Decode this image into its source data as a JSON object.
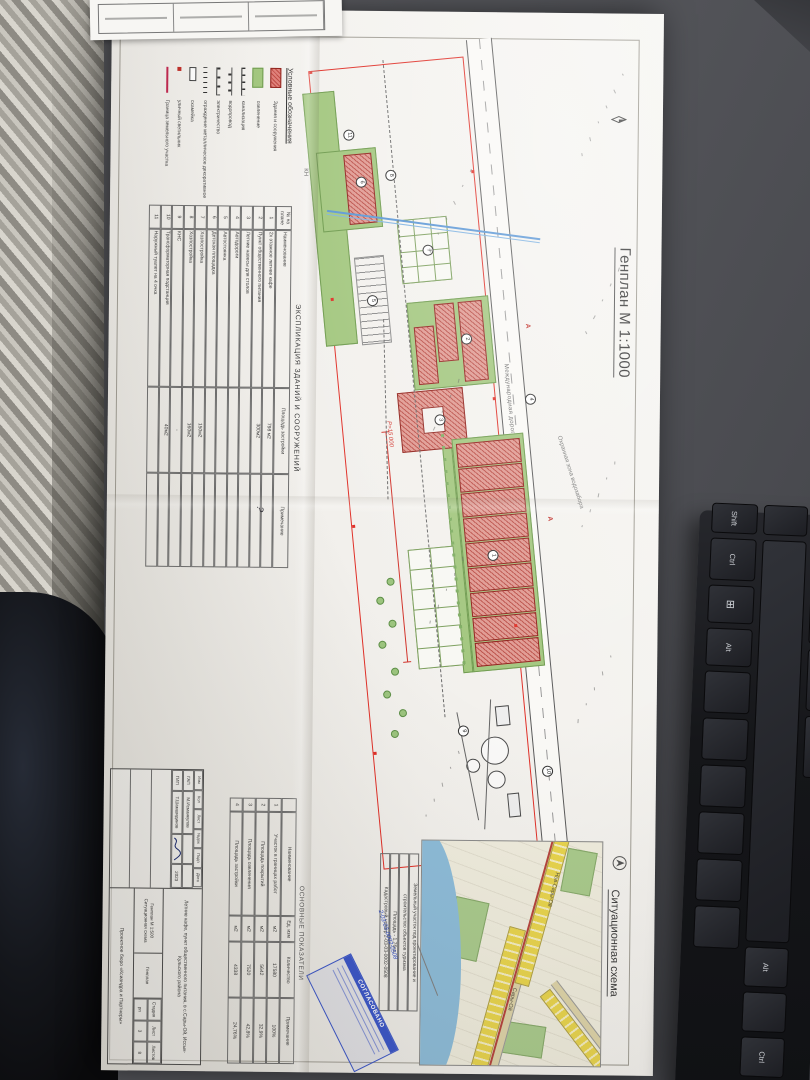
{
  "document": {
    "title": "Генплан М 1:1000",
    "situational_title": "Ситуационная схема",
    "kn_label": "КН"
  },
  "plan": {
    "road_label": "Международная дорога",
    "zone_label": "Охранная зона водозабора",
    "radius_label": "Р=15 000",
    "section_mark": "А",
    "badges": [
      "1",
      "2",
      "3",
      "4",
      "5",
      "6",
      "7",
      "8",
      "9",
      "10",
      "11"
    ]
  },
  "legend": {
    "title": "Условные обозначения",
    "items": [
      {
        "symbol": "building",
        "label": "Здания и сооружения"
      },
      {
        "symbol": "greenery",
        "label": "озеленение"
      },
      {
        "symbol": "sewer",
        "label": "канализация"
      },
      {
        "symbol": "water",
        "label": "водопровод"
      },
      {
        "symbol": "electric",
        "label": "электричество"
      },
      {
        "symbol": "fence",
        "label": "ограждение металлическое декоративное"
      },
      {
        "symbol": "bench",
        "label": "скамейка"
      },
      {
        "symbol": "lamp",
        "label": "уличный светильник"
      },
      {
        "symbol": "boundary",
        "label": "Граница земельного участка"
      }
    ]
  },
  "explication": {
    "title": "ЭКСПЛИКАЦИЯ ЗДАНИЙ И СООРУЖЕНИЙ",
    "columns": [
      "№ на плане",
      "Наименование",
      "Площадь застройки",
      "Примечание"
    ],
    "rows": [
      [
        "1",
        "2х этажное летнее кафе",
        "798 м2",
        ""
      ],
      [
        "2",
        "Пункт общественного питания",
        "300м2",
        ""
      ],
      [
        "3",
        "Летние навесы для столов",
        "",
        ""
      ],
      [
        "4",
        "Автодороги",
        "",
        ""
      ],
      [
        "5",
        "Автостоянка",
        "",
        ""
      ],
      [
        "6",
        "Детская площадка",
        "",
        ""
      ],
      [
        "7",
        "Хозпостройка",
        "150м2",
        ""
      ],
      [
        "8",
        "Хозпостройка",
        "160м2",
        ""
      ],
      [
        "9",
        "КНС",
        "-",
        ""
      ],
      [
        "10",
        "Трансформаторная подстанция",
        "40м2",
        ""
      ],
      [
        "11",
        "Наружный туалет на 4 очка",
        "",
        ""
      ]
    ],
    "handwritten_mark": "?"
  },
  "indicators": {
    "title": "ОСНОВНЫЕ ПОКАЗАТЕЛИ",
    "columns": [
      "",
      "Наименование",
      "Ед. изм",
      "Количество",
      "Примечание"
    ],
    "rows": [
      [
        "1",
        "Участок в границах работ",
        "м2",
        "17580",
        "100%"
      ],
      [
        "2",
        "Площадь покрытий",
        "м2",
        "5642",
        "32,9%"
      ],
      [
        "3",
        "Площадь озеленения",
        "м2",
        "7520",
        "42,8%"
      ],
      [
        "4",
        "Площадь застройки",
        "м2",
        "4338",
        "24,76%"
      ]
    ]
  },
  "situational_map": {
    "settlements": [
      "Нов-Сары-Ой",
      "Сары-Ой"
    ],
    "annotation_lines": [
      "Земельный участок под проектирование и",
      "строительство объектов туризма",
      "Площадь - 1,76га.",
      "Кадастровый номер 2-03-03-0002-0508"
    ],
    "stamp_text": "СОГЛАСОВАНО",
    "pen_note": "2-03-03-0002-0508"
  },
  "titleblock": {
    "header_cells": [
      "Изм",
      "Кол",
      "Лист",
      "№док",
      "Подп",
      "Дата"
    ],
    "signers": [
      {
        "role": "ГАП",
        "name": "М.Исманкулов",
        "date": ""
      },
      {
        "role": "ГИП",
        "name": "Т.Шамшидинов",
        "date": "2023"
      }
    ],
    "project": "Летние кафе, пункт общественного питания, в с.Сары-Ой, Иссык-Кульского района",
    "doc_scale_note": "Генплан М 1:500 Ситуационная схема",
    "sheet_name": "Генплан",
    "stage_columns": [
      "Стадия",
      "Лист",
      "Листов"
    ],
    "stage_values": [
      "рп",
      "3",
      "8"
    ],
    "firm": "Проектное бюро «Ксиандра и Партнеры»"
  },
  "keyboard": {
    "keys": [
      "Shift",
      "Ctrl",
      "⊞",
      "Alt"
    ],
    "lower_keys": [
      "Alt",
      "Ctrl"
    ]
  },
  "colors": {
    "building_red": "#cf5148",
    "greenery_green": "#9cc47e",
    "boundary_red": "#e03028",
    "stamp_blue": "#3a55c8",
    "map_water": "#8dbcd9",
    "map_road_yellow": "#e8d44d"
  }
}
